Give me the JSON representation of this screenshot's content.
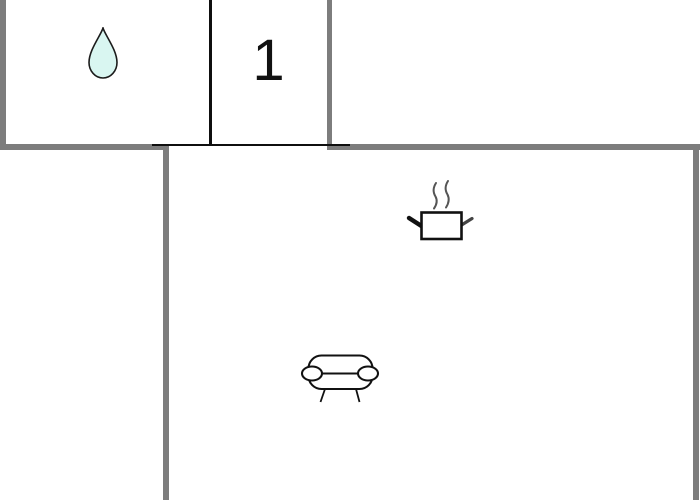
{
  "floorplan": {
    "type": "apartment-floor-plan",
    "background_color": "#ffffff",
    "walls": {
      "exterior_color": "#7d7d7d",
      "interior_color": "#0f0f0f"
    },
    "rooms": [
      {
        "name": "bathroom",
        "icons": [
          "water-drop-icon"
        ],
        "label": ""
      },
      {
        "name": "bedroom",
        "icons": [],
        "label": "1"
      },
      {
        "name": "living-room-kitchen",
        "icons": [
          "cooking-pot-icon",
          "sofa-icon"
        ],
        "label": ""
      }
    ],
    "labels": {
      "bedroom_number": "1"
    },
    "icons": {
      "water_drop": {
        "fill": "#d9f6f1",
        "stroke": "#1c1c1c"
      },
      "cooking_pot": {
        "stroke": "#111111",
        "steam_color": "#555555"
      },
      "sofa": {
        "stroke": "#111111"
      }
    }
  }
}
